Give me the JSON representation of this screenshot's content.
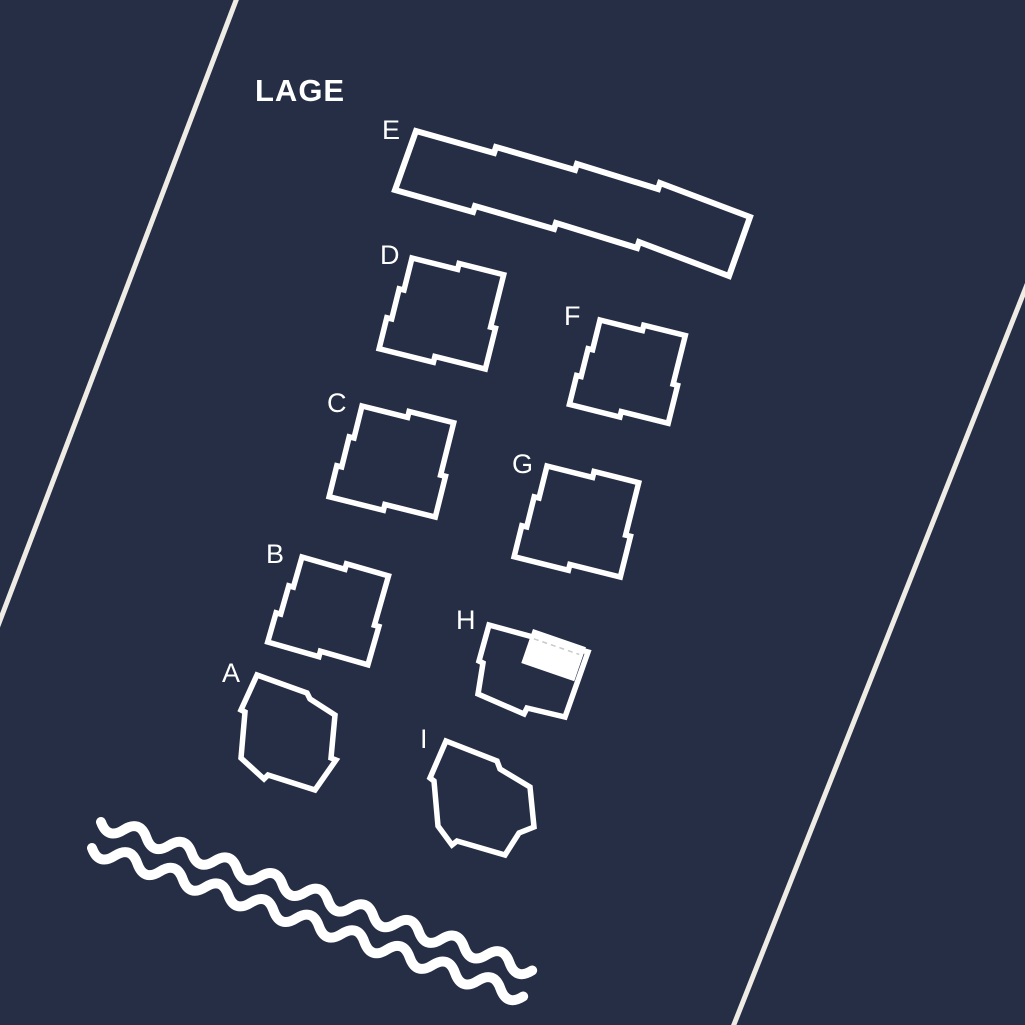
{
  "title": "LAGE",
  "map": {
    "buildings": [
      {
        "id": "A",
        "label": "A",
        "highlighted": false
      },
      {
        "id": "B",
        "label": "B",
        "highlighted": false
      },
      {
        "id": "C",
        "label": "C",
        "highlighted": false
      },
      {
        "id": "D",
        "label": "D",
        "highlighted": false
      },
      {
        "id": "E",
        "label": "E",
        "highlighted": false
      },
      {
        "id": "F",
        "label": "F",
        "highlighted": false
      },
      {
        "id": "G",
        "label": "G",
        "highlighted": false
      },
      {
        "id": "H",
        "label": "H",
        "highlighted": true
      },
      {
        "id": "I",
        "label": "I",
        "highlighted": false
      }
    ],
    "colors": {
      "background": "#252e44",
      "building_outline": "#ffffff",
      "label_text": "#ffffff",
      "road_line": "#efece6",
      "water_line": "#ffffff",
      "highlight_fill": "#ffffff",
      "highlight_dash": "#c9c9c9"
    }
  }
}
